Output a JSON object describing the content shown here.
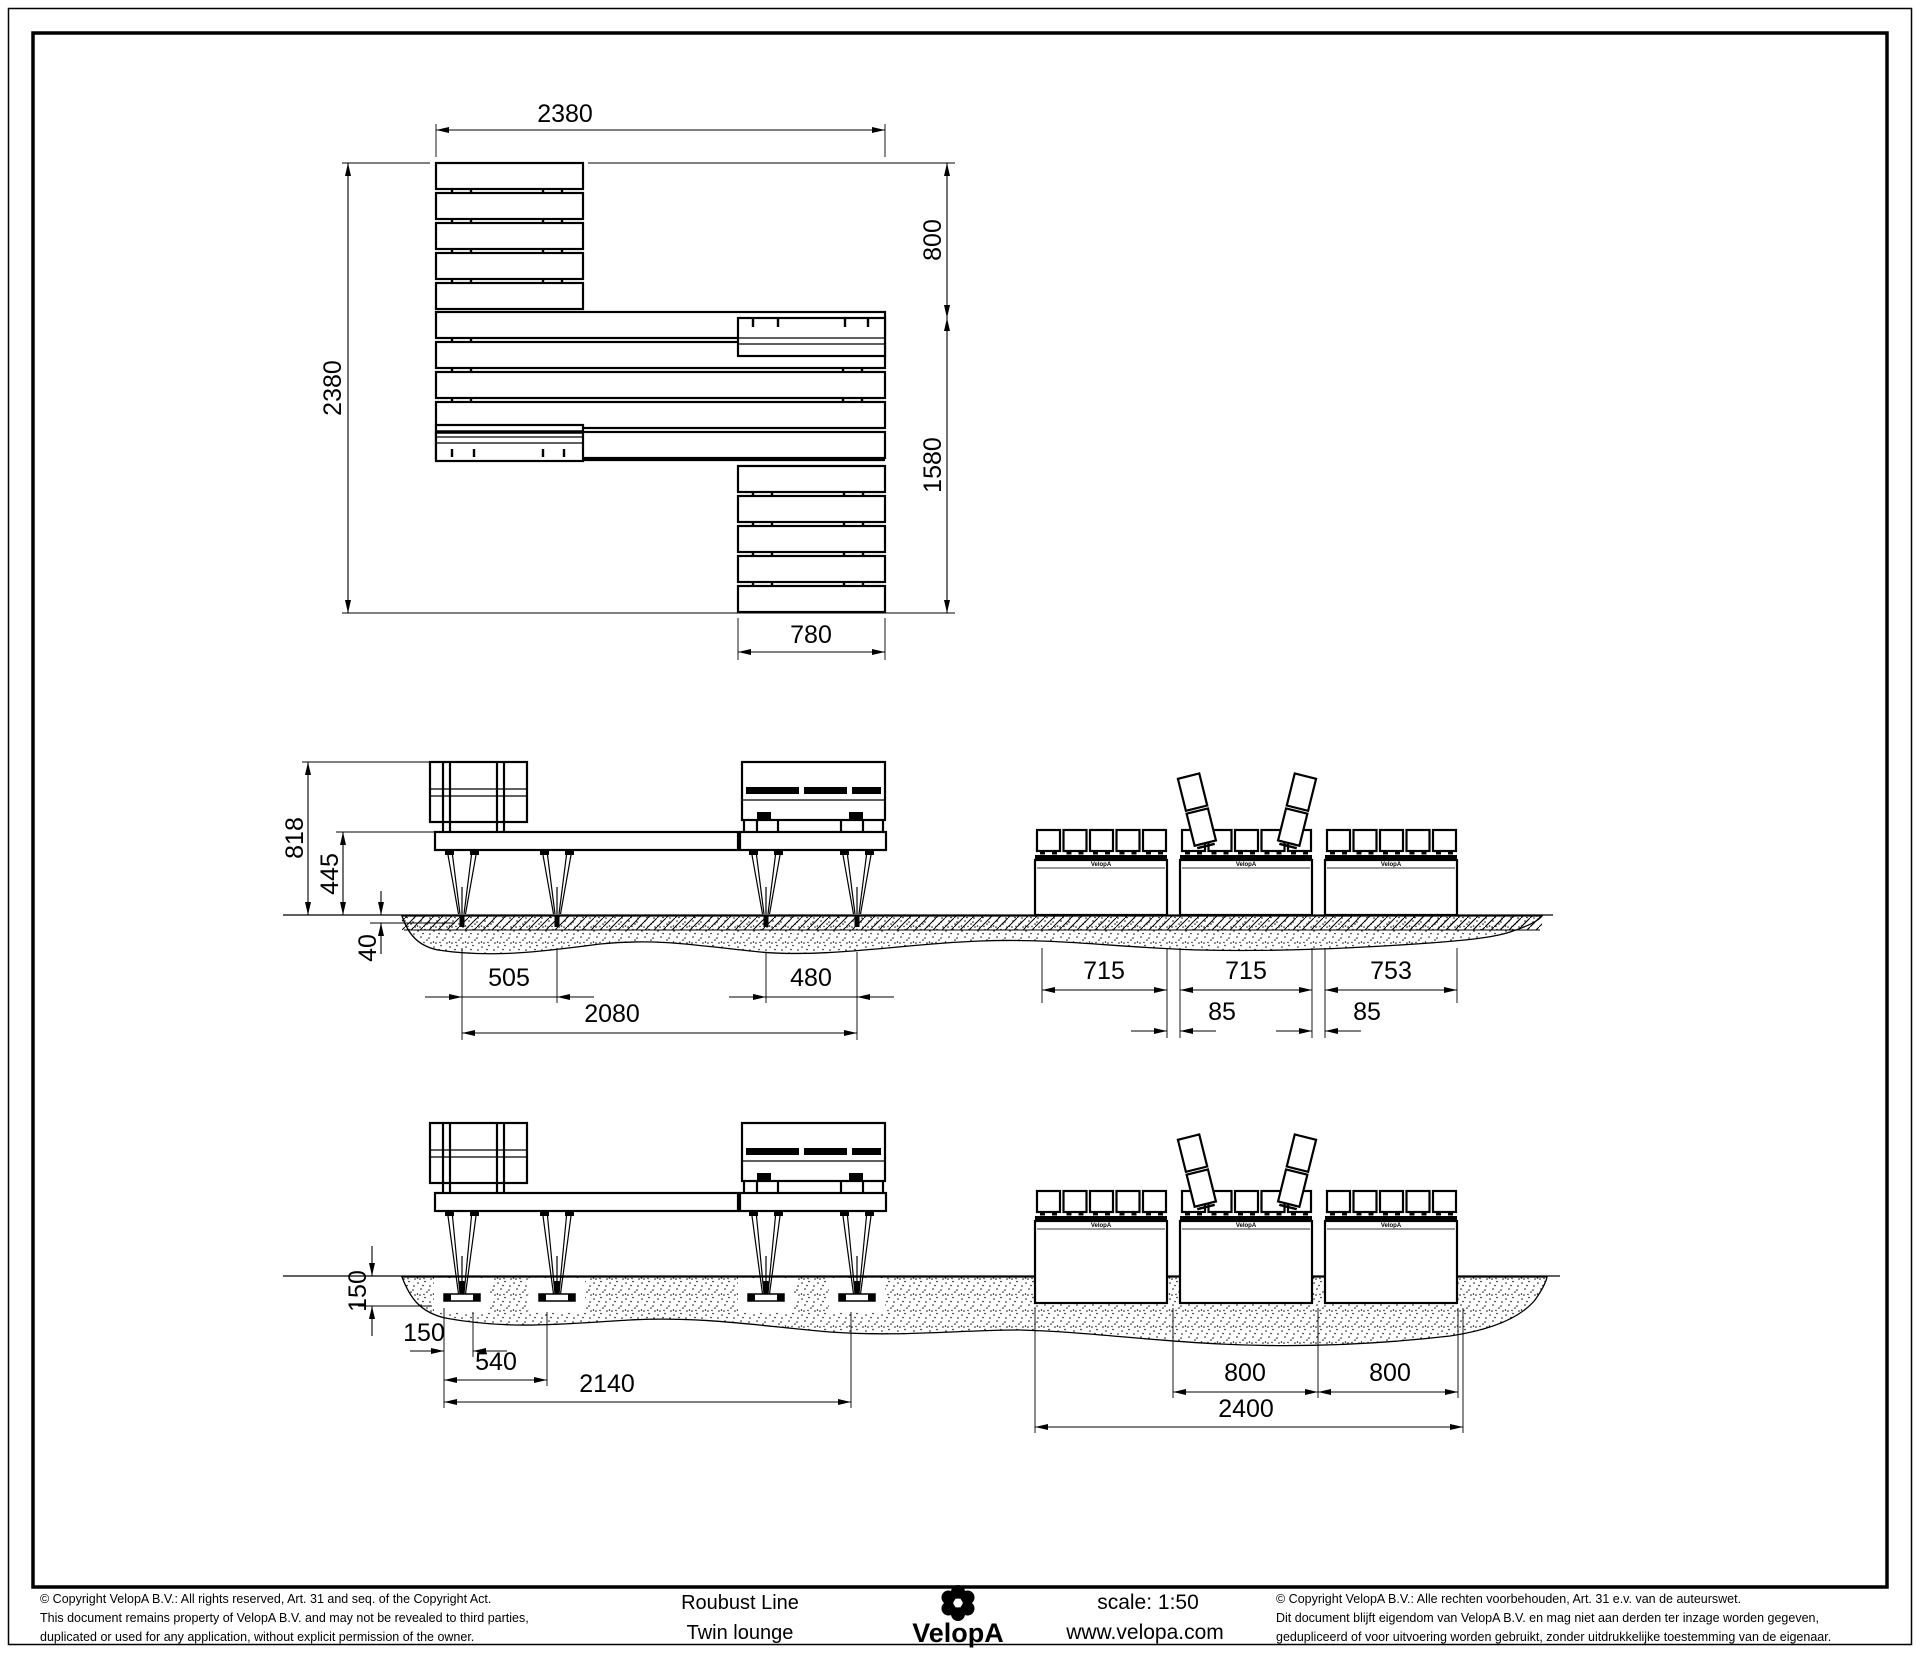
{
  "plan_view": {
    "overall_width": "2380",
    "overall_depth": "2380",
    "back_offset": "800",
    "side_length": "1580",
    "bench_width": "780"
  },
  "surface_elevation": {
    "total_height": "818",
    "seat_height": "445",
    "anchor_depth": "40",
    "leg_spacing_left": "505",
    "leg_spacing_right": "480",
    "leg_span": "2080",
    "module_1": "715",
    "module_2": "715",
    "module_3": "753",
    "joint_1": "85",
    "joint_2": "85"
  },
  "inground_elevation": {
    "foundation_depth": "150",
    "foot_width": "150",
    "foot_spacing": "540",
    "foot_span": "2140",
    "module_pitch_1": "800",
    "module_pitch_2": "800",
    "overall_length": "2400"
  },
  "panel": {
    "brand_mark": "VelopA"
  },
  "title_block": {
    "copyright_en_line1": "©  Copyright VelopA B.V.: All rights reserved, Art. 31 and seq. of the Copyright Act.",
    "copyright_en_line2": "This document remains property of VelopA B.V. and may not be revealed to third parties,",
    "copyright_en_line3": "duplicated or used for any application, without explicit permission of the owner.",
    "product_line": "Roubust Line",
    "product_model": "Twin lounge",
    "brand": "VelopA",
    "scale_label": "scale: 1:50",
    "website": "www.velopa.com",
    "copyright_nl_line1": "©  Copyright VelopA B.V.: Alle rechten voorbehouden, Art. 31 e.v. van de auteurswet.",
    "copyright_nl_line2": "Dit document blijft eigendom van VelopA B.V. en mag niet aan derden ter inzage worden gegeven,",
    "copyright_nl_line3": "gedupliceerd of voor uitvoering worden gebruikt, zonder uitdrukkelijke toestemming van de eigenaar."
  }
}
